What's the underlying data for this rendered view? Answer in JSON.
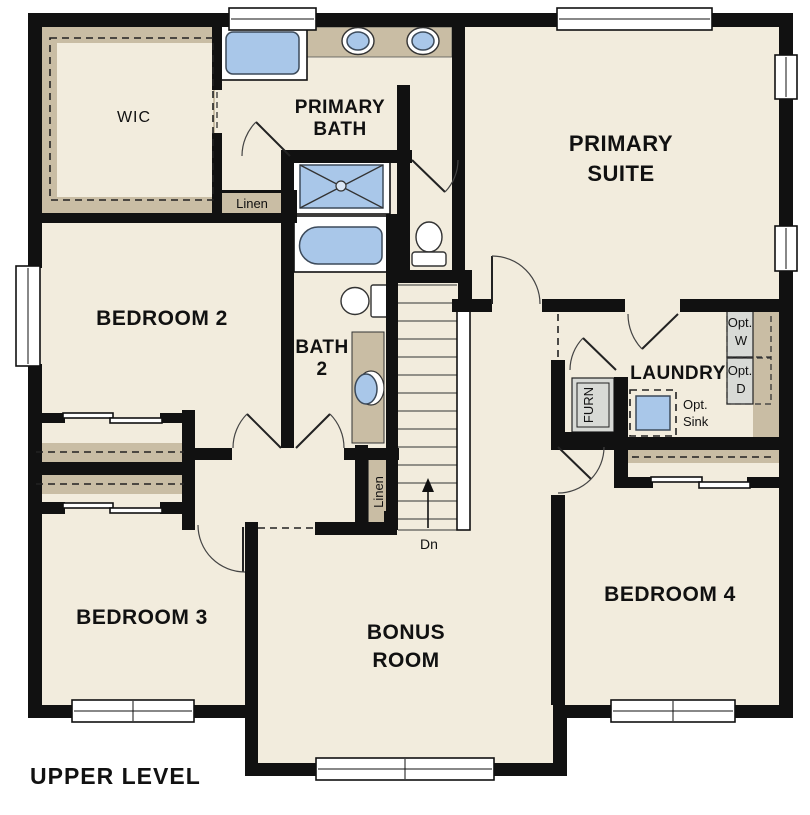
{
  "plan": {
    "title": "UPPER LEVEL",
    "level": "upper",
    "labels": {
      "wic": "WIC",
      "primary_bath_1": "PRIMARY",
      "primary_bath_2": "BATH",
      "primary_suite_1": "PRIMARY",
      "primary_suite_2": "SUITE",
      "linen_upper": "Linen",
      "linen_stairs": "Linen",
      "bedroom2": "BEDROOM 2",
      "bath2_1": "BATH",
      "bath2_2": "2",
      "laundry": "LAUNDRY",
      "furnace": "FURN",
      "opt_w_1": "Opt.",
      "opt_w_2": "W",
      "opt_d_1": "Opt.",
      "opt_d_2": "D",
      "opt_sink_1": "Opt.",
      "opt_sink_2": "Sink",
      "down": "Dn",
      "bedroom3": "BEDROOM 3",
      "bonus_1": "BONUS",
      "bonus_2": "ROOM",
      "bedroom4": "BEDROOM 4"
    }
  },
  "colors": {
    "floor": "#f2ecdd",
    "wall": "#111111",
    "tan": "#c9bda4",
    "blue": "#a9c7e9",
    "gray": "#d8dad6"
  }
}
